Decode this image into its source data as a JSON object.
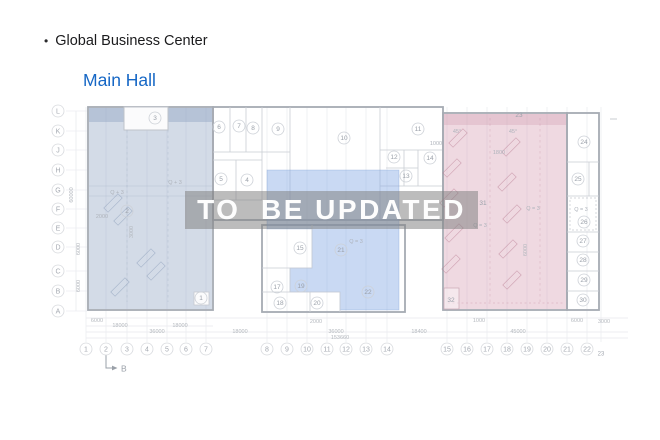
{
  "header": {
    "bullet": "•",
    "title": "Global Business Center",
    "subtitle": "Main Hall"
  },
  "watermark": {
    "text": "TO  BE UPDATED"
  },
  "colors": {
    "subtitle_blue": "#1667c5",
    "left_block_fill": "#b7c3d4",
    "middle_block_fill": "#b3c9ec",
    "right_block_fill": "#e4c9d3",
    "watermark_bg": "#9c9c9c",
    "watermark_text": "#ffffff"
  },
  "plan": {
    "section_label": "B",
    "grid_letters": [
      {
        "label": "L",
        "y": 111
      },
      {
        "label": "K",
        "y": 131
      },
      {
        "label": "J",
        "y": 150
      },
      {
        "label": "H",
        "y": 170
      },
      {
        "label": "G",
        "y": 190
      },
      {
        "label": "F",
        "y": 209
      },
      {
        "label": "E",
        "y": 228
      },
      {
        "label": "D",
        "y": 247
      },
      {
        "label": "C",
        "y": 271
      },
      {
        "label": "B",
        "y": 291
      },
      {
        "label": "A",
        "y": 311
      }
    ],
    "grid_numbers": [
      {
        "label": "1",
        "x": 86
      },
      {
        "label": "2",
        "x": 106
      },
      {
        "label": "3",
        "x": 127
      },
      {
        "label": "4",
        "x": 147
      },
      {
        "label": "5",
        "x": 167
      },
      {
        "label": "6",
        "x": 186
      },
      {
        "label": "7",
        "x": 206
      },
      {
        "label": "8",
        "x": 267
      },
      {
        "label": "9",
        "x": 287
      },
      {
        "label": "10",
        "x": 307
      },
      {
        "label": "11",
        "x": 327
      },
      {
        "label": "12",
        "x": 346
      },
      {
        "label": "13",
        "x": 366
      },
      {
        "label": "14",
        "x": 387
      },
      {
        "label": "15",
        "x": 447
      },
      {
        "label": "16",
        "x": 467
      },
      {
        "label": "17",
        "x": 487
      },
      {
        "label": "18",
        "x": 507
      },
      {
        "label": "19",
        "x": 527
      },
      {
        "label": "20",
        "x": 547
      },
      {
        "label": "21",
        "x": 567
      },
      {
        "label": "22",
        "x": 587
      },
      {
        "label": "23",
        "x": 601,
        "y": 353,
        "c": false
      }
    ],
    "rooms": [
      {
        "label": "1",
        "x": 201,
        "y": 298
      },
      {
        "label": "2",
        "x": 127,
        "y": 211
      },
      {
        "label": "3",
        "x": 155,
        "y": 118
      },
      {
        "label": "4",
        "x": 247,
        "y": 180
      },
      {
        "label": "5",
        "x": 221,
        "y": 179
      },
      {
        "label": "6",
        "x": 219,
        "y": 127
      },
      {
        "label": "7",
        "x": 239,
        "y": 126
      },
      {
        "label": "8",
        "x": 253,
        "y": 128
      },
      {
        "label": "9",
        "x": 278,
        "y": 129
      },
      {
        "label": "10",
        "x": 344,
        "y": 138
      },
      {
        "label": "11",
        "x": 418,
        "y": 129
      },
      {
        "label": "12",
        "x": 394,
        "y": 157
      },
      {
        "label": "13",
        "x": 406,
        "y": 176
      },
      {
        "label": "14",
        "x": 430,
        "y": 158
      },
      {
        "label": "15",
        "x": 300,
        "y": 248
      },
      {
        "label": "17",
        "x": 277,
        "y": 287
      },
      {
        "label": "18",
        "x": 280,
        "y": 303
      },
      {
        "label": "19",
        "x": 301,
        "y": 286
      },
      {
        "label": "20",
        "x": 317,
        "y": 303
      },
      {
        "label": "21",
        "x": 341,
        "y": 250
      },
      {
        "label": "22",
        "x": 368,
        "y": 292
      },
      {
        "label": "23",
        "x": 519,
        "y": 115,
        "c": false
      },
      {
        "label": "24",
        "x": 584,
        "y": 142
      },
      {
        "label": "25",
        "x": 578,
        "y": 179
      },
      {
        "label": "26",
        "x": 584,
        "y": 222
      },
      {
        "label": "27",
        "x": 583,
        "y": 241
      },
      {
        "label": "28",
        "x": 583,
        "y": 260
      },
      {
        "label": "29",
        "x": 584,
        "y": 280
      },
      {
        "label": "30",
        "x": 583,
        "y": 300
      },
      {
        "label": "31",
        "x": 483,
        "y": 203,
        "c": false
      },
      {
        "label": "32",
        "x": 451,
        "y": 300,
        "c": false
      }
    ],
    "annotations": [
      {
        "text": "Q + 3",
        "x": 117,
        "y": 194
      },
      {
        "text": "Q + 3",
        "x": 175,
        "y": 184
      },
      {
        "text": "2000",
        "x": 102,
        "y": 218
      },
      {
        "text": "Q = 3",
        "x": 356,
        "y": 243
      },
      {
        "text": "Q = 3",
        "x": 480,
        "y": 227
      },
      {
        "text": "Q = 3",
        "x": 533,
        "y": 210
      },
      {
        "text": "Q = 3",
        "x": 581,
        "y": 211
      },
      {
        "text": "1800",
        "x": 499,
        "y": 154
      },
      {
        "text": "1000",
        "x": 436,
        "y": 145
      },
      {
        "text": "45°",
        "x": 457,
        "y": 133
      },
      {
        "text": "45°",
        "x": 513,
        "y": 133
      }
    ],
    "dimensions": [
      {
        "text": "6000",
        "x": 97,
        "y": 322
      },
      {
        "text": "18000",
        "x": 120,
        "y": 327
      },
      {
        "text": "18000",
        "x": 180,
        "y": 327
      },
      {
        "text": "36000",
        "x": 157,
        "y": 333
      },
      {
        "text": "18000",
        "x": 240,
        "y": 333
      },
      {
        "text": "2000",
        "x": 316,
        "y": 323
      },
      {
        "text": "36000",
        "x": 336,
        "y": 333
      },
      {
        "text": "153660",
        "x": 340,
        "y": 339
      },
      {
        "text": "18400",
        "x": 419,
        "y": 333
      },
      {
        "text": "1000",
        "x": 479,
        "y": 322
      },
      {
        "text": "45000",
        "x": 518,
        "y": 333
      },
      {
        "text": "6000",
        "x": 577,
        "y": 322
      },
      {
        "text": "3000",
        "x": 604,
        "y": 323
      }
    ],
    "vertical_dimensions": [
      {
        "text": "60000",
        "x": 73,
        "y": 195
      },
      {
        "text": "6000",
        "x": 80,
        "y": 249
      },
      {
        "text": "6000",
        "x": 80,
        "y": 286
      },
      {
        "text": "3000",
        "x": 133,
        "y": 232
      },
      {
        "text": "6000",
        "x": 527,
        "y": 250
      }
    ]
  }
}
